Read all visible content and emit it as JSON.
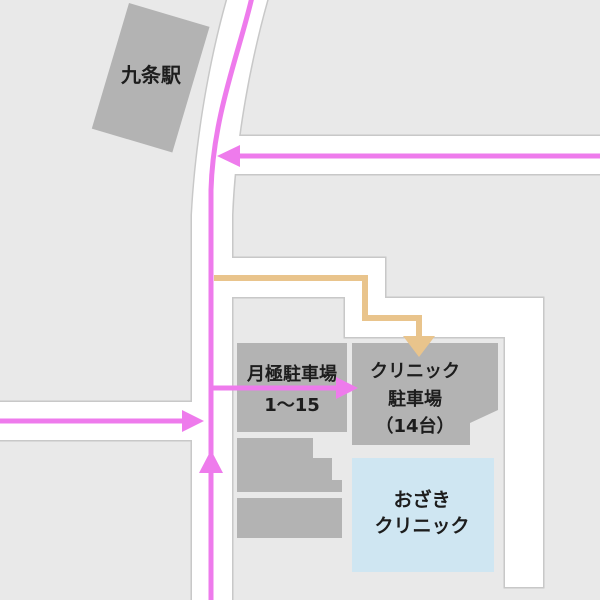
{
  "map": {
    "kind": "clinic-access-map",
    "colors": {
      "background_block": "#e9e9e9",
      "road": "#ffffff",
      "road_border": "#c8c8c8",
      "building_gray": "#b3b3b3",
      "clinic_blue": "#cfe6f2",
      "route_pink": "#ee7bec",
      "route_tan": "#e9c48c",
      "label_text": "#1d1d1d"
    },
    "labels": {
      "station": "九条駅",
      "monthly_parking_name": "月極駐車場",
      "monthly_parking_numbers": "1〜15",
      "clinic_parking_line1": "クリニック",
      "clinic_parking_line2": "駐車場",
      "clinic_parking_line3": "（14台）",
      "clinic_line1": "おざき",
      "clinic_line2": "クリニック"
    }
  }
}
